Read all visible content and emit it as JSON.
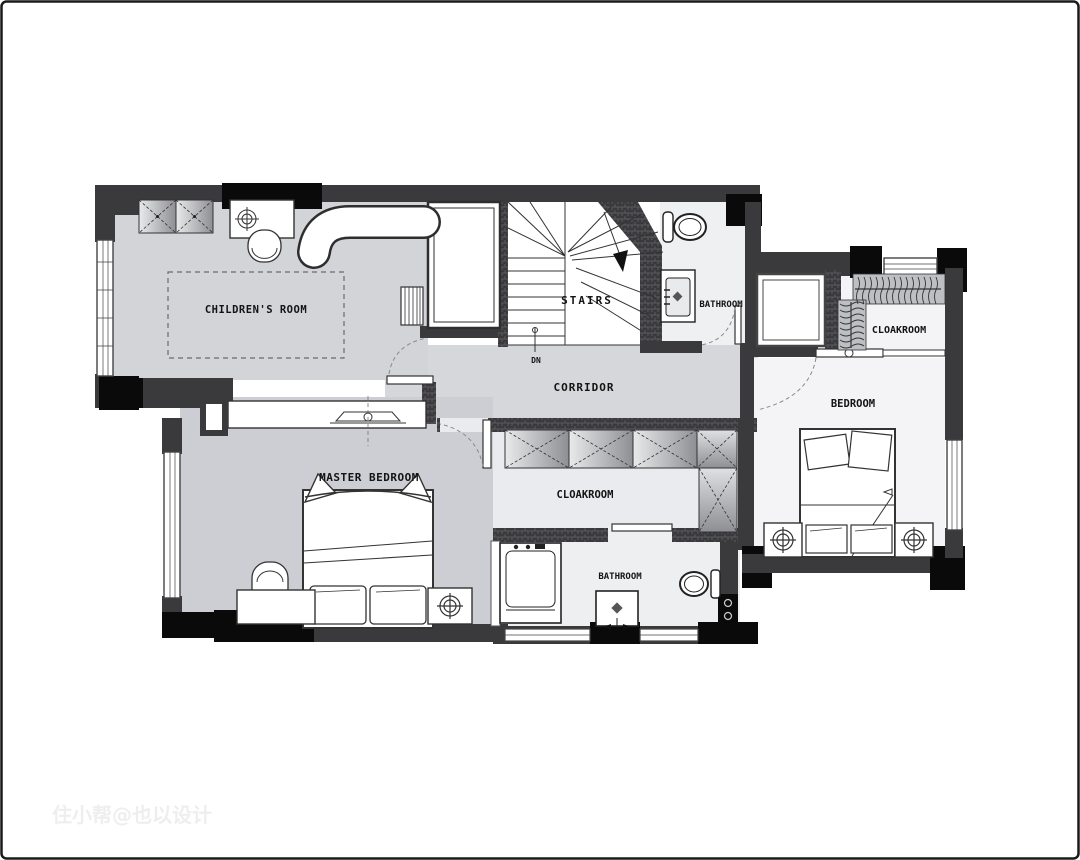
{
  "plan": {
    "type": "residential floor plan (upper level)",
    "rooms": {
      "childrens_room": {
        "label": "CHILDREN'S ROOM"
      },
      "stairs": {
        "label": "STAIRS",
        "direction_note": "DN"
      },
      "bathroom_top": {
        "label": "BATHROOM"
      },
      "cloakroom_right": {
        "label": "CLOAKROOM"
      },
      "bedroom": {
        "label": "BEDROOM"
      },
      "corridor": {
        "label": "CORRIDOR"
      },
      "cloakroom_center": {
        "label": "CLOAKROOM"
      },
      "master_bedroom": {
        "label": "MASTER BEDROOM"
      },
      "bathroom_bottom": {
        "label": "BATHROOM"
      }
    },
    "watermark": "住小帮@也以设计",
    "colors": {
      "wall_dark": "#3a3a3c",
      "wall_black": "#0a0a0a",
      "floor_gray": "#ced1d5",
      "floor_light": "#edeff0",
      "line": "#333333"
    }
  }
}
